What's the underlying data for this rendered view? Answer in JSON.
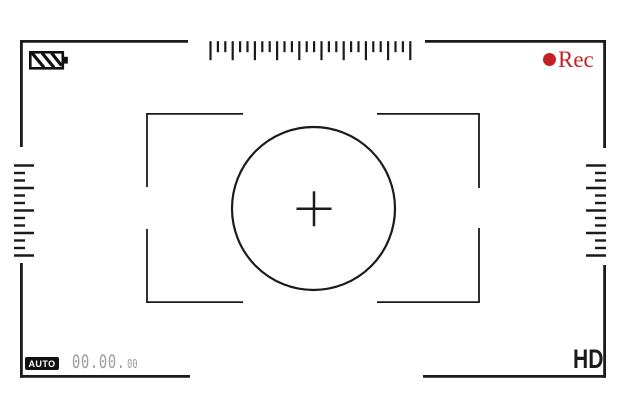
{
  "rec": {
    "label": "Rec"
  },
  "auto": {
    "label": "AUTO"
  },
  "timecode": {
    "main": "00.00.",
    "frames": "00"
  },
  "quality": {
    "label": "HD"
  },
  "colors": {
    "frame_line": "#1b1b1b",
    "rec_red": "#c32127",
    "timecode_gray": "#9e9e9e",
    "badge_black": "#101010",
    "background": "#ffffff"
  },
  "rulers": {
    "top": {
      "tick_count": 28,
      "pattern": "long-short-short"
    },
    "left": {
      "tick_count": 13,
      "pattern": "long-short-short"
    },
    "right": {
      "tick_count": 13,
      "pattern": "long-short-short"
    }
  },
  "icons": {
    "battery": "battery-icon",
    "rec_dot": "rec-dot-icon",
    "crosshair": "crosshair-icon"
  }
}
